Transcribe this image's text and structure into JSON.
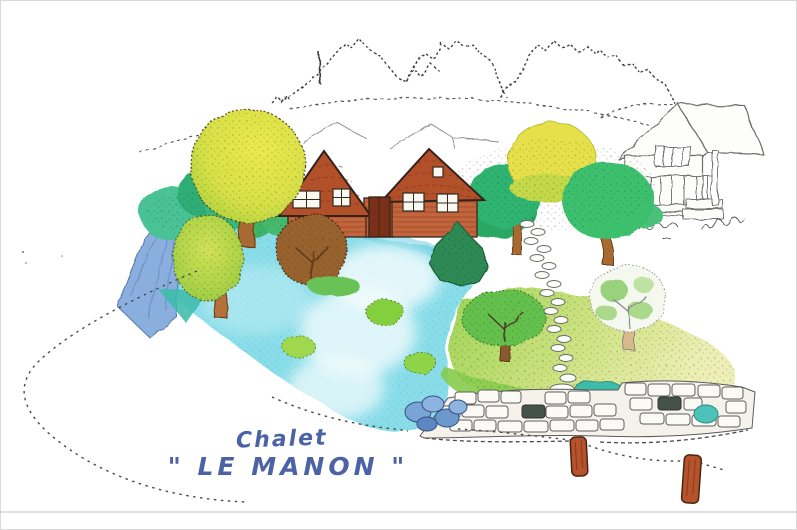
{
  "scene": {
    "caption": {
      "line1": "Chalet",
      "line2": "\"  LE MANON  \""
    }
  },
  "palette": {
    "caption_blue": "#4b63a4",
    "pond_turquoise": "#88dde9",
    "pond_deep": "#5fc9dc",
    "water_wedge_blue": "#8aaede",
    "teal_accent": "#3dbcab",
    "chalet_wall": "#c2653c",
    "chalet_roof": "#b2502a",
    "door_brown": "#7a3018",
    "tree_yellow": "#e6e14b",
    "tree_yellow_green": "#b5d743",
    "tree_green": "#3cc06e",
    "tree_teal": "#48c296",
    "conifer_green": "#2e8a55",
    "bush_brown": "#97622e",
    "grass_green": "#86cc4e",
    "grass_yellow": "#e9edaa",
    "trunk_brown": "#a86a30",
    "post_brown": "#b5532c",
    "sketch_gray": "#3f3f3f",
    "house_line_gray": "#6e6e6e"
  },
  "objects": {
    "mountains": "mountain skyline sketch",
    "chalet": "two-gable wooden chalet",
    "neighbour_house": "neighbouring house line drawing",
    "pond": "turquoise pond",
    "wedge": "blue tarpaulin water inlet",
    "stone_wall": "dry-stone retaining wall",
    "rope_fence": "wooden posts with rope",
    "driveway": "dotted driveway curve",
    "stepping_stones": "stepping-stone path"
  }
}
